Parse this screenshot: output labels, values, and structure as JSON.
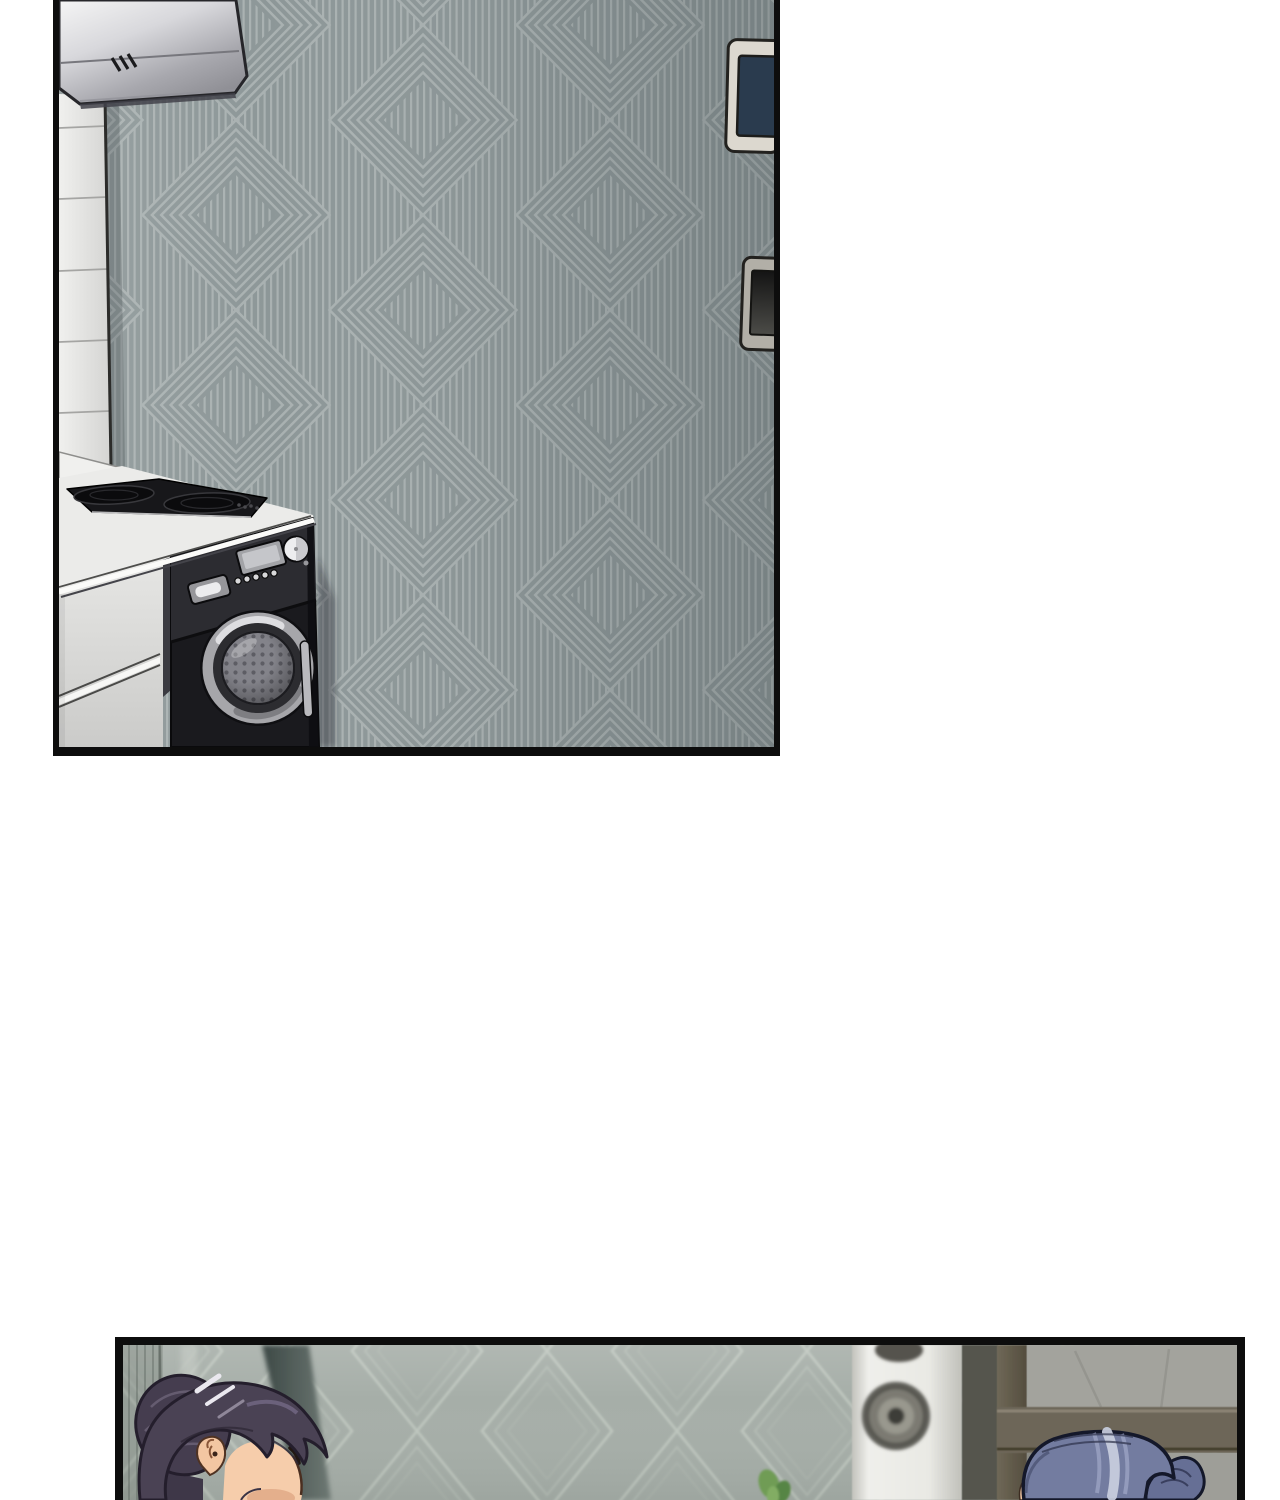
{
  "page": {
    "background": "#ffffff",
    "media_type": "webtoon-comic-strip",
    "visible_text": "none",
    "panel_count": 2
  },
  "panel_kitchen": {
    "description": "Comic panel of an empty kitchen: stainless steel range hood above a black two-burner cooktop on a white counter, a built-in black front-loading washing machine, a white tiled side wall, gray diamond-striped wallpaper, a wall thermostat with a dark navy screen and a dark wall vent on the right edge.",
    "border_color": "#0d0d0d",
    "wallpaper_base": "#8d9798",
    "wallpaper_line": "#a9b1b1",
    "tile_color": "#e9e9e7",
    "hood_metal": "#d8d8dc",
    "counter_color": "#ebebe9",
    "cabinet_color": "#d9d9d7",
    "cooktop_color": "#17171a",
    "washer_body": "#1a1a1e",
    "washer_drum": "#83838a",
    "washer_ring": "#a6a6aa",
    "thermostat_frame": "#dcd8cf",
    "thermostat_screen": "#2a3b4e",
    "vent_frame": "#b2afa7",
    "vent_screen": "#141414"
  },
  "panel_livingroom": {
    "description": "Comic panel of two characters: a woman with dark purple hair in a bun seen in profile at left, and the top of a second character's blue-gray ponytailed head at lower right, against sage diamond wallpaper with a white speaker tower, a small green plant and a dark wooden door frame.",
    "border_color": "#0d0d0d",
    "wallpaper_base": "#a6aea8",
    "wallpaper_line": "#bec6be",
    "woman_hair": "#4a4254",
    "woman_hair_highlight": "#eae8ef",
    "woman_skin": "#f6cdab",
    "second_hair": "#737ca0",
    "second_hair_shine": "#c9cede",
    "second_skin": "#f2c7a4",
    "speaker_color": "#ebebe7",
    "speaker_cone": "#504f4a",
    "frame_wood": "#6f6857",
    "plant_green": "#6f9c55",
    "shadow_bar": "#3d4946"
  }
}
